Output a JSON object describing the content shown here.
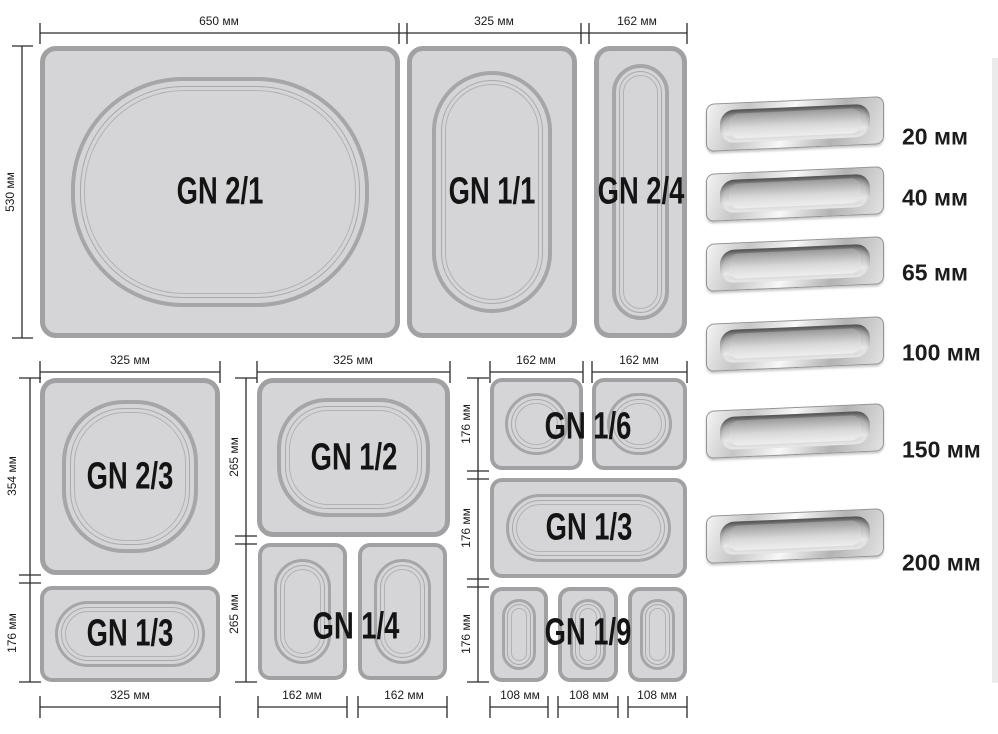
{
  "diagram": {
    "top_row": {
      "width_labels": [
        "650 мм",
        "325 мм",
        "162 мм"
      ],
      "height_label": "530 мм",
      "pans": [
        {
          "label": "GN 2/1"
        },
        {
          "label": "GN 1/1"
        },
        {
          "label": "GN 2/4"
        }
      ]
    },
    "bottom_left_column": {
      "top_width_label": "325 мм",
      "height_labels": [
        "354 мм",
        "176 мм"
      ],
      "pans": [
        {
          "label": "GN 2/3"
        },
        {
          "label": "GN 1/3"
        }
      ],
      "bottom_width_label": "325 мм"
    },
    "bottom_middle_column": {
      "top_width_label": "325 мм",
      "height_labels": [
        "265 мм",
        "265 мм"
      ],
      "pans": [
        {
          "label": "GN 1/2"
        },
        {
          "label": "GN 1/4"
        }
      ],
      "bottom_width_labels": [
        "162 мм",
        "162 мм"
      ]
    },
    "bottom_right_column": {
      "top_width_labels": [
        "162 мм",
        "162 мм"
      ],
      "height_labels": [
        "176 мм",
        "176 мм",
        "176 мм"
      ],
      "pans": [
        {
          "label": "GN 1/6"
        },
        {
          "label": "GN 1/3"
        },
        {
          "label": "GN 1/9"
        }
      ],
      "bottom_width_labels": [
        "108 мм",
        "108 мм",
        "108 мм"
      ]
    }
  },
  "depth_legend": {
    "items": [
      {
        "label": "20 мм"
      },
      {
        "label": "40 мм"
      },
      {
        "label": "65 мм"
      },
      {
        "label": "100 мм"
      },
      {
        "label": "150 мм"
      },
      {
        "label": "200 мм"
      }
    ]
  },
  "colors": {
    "pan_fill": "#d5d5d7",
    "pan_border": "#a1a1a3",
    "dimension_line": "#2a2a2a",
    "label_text": "#141414"
  }
}
